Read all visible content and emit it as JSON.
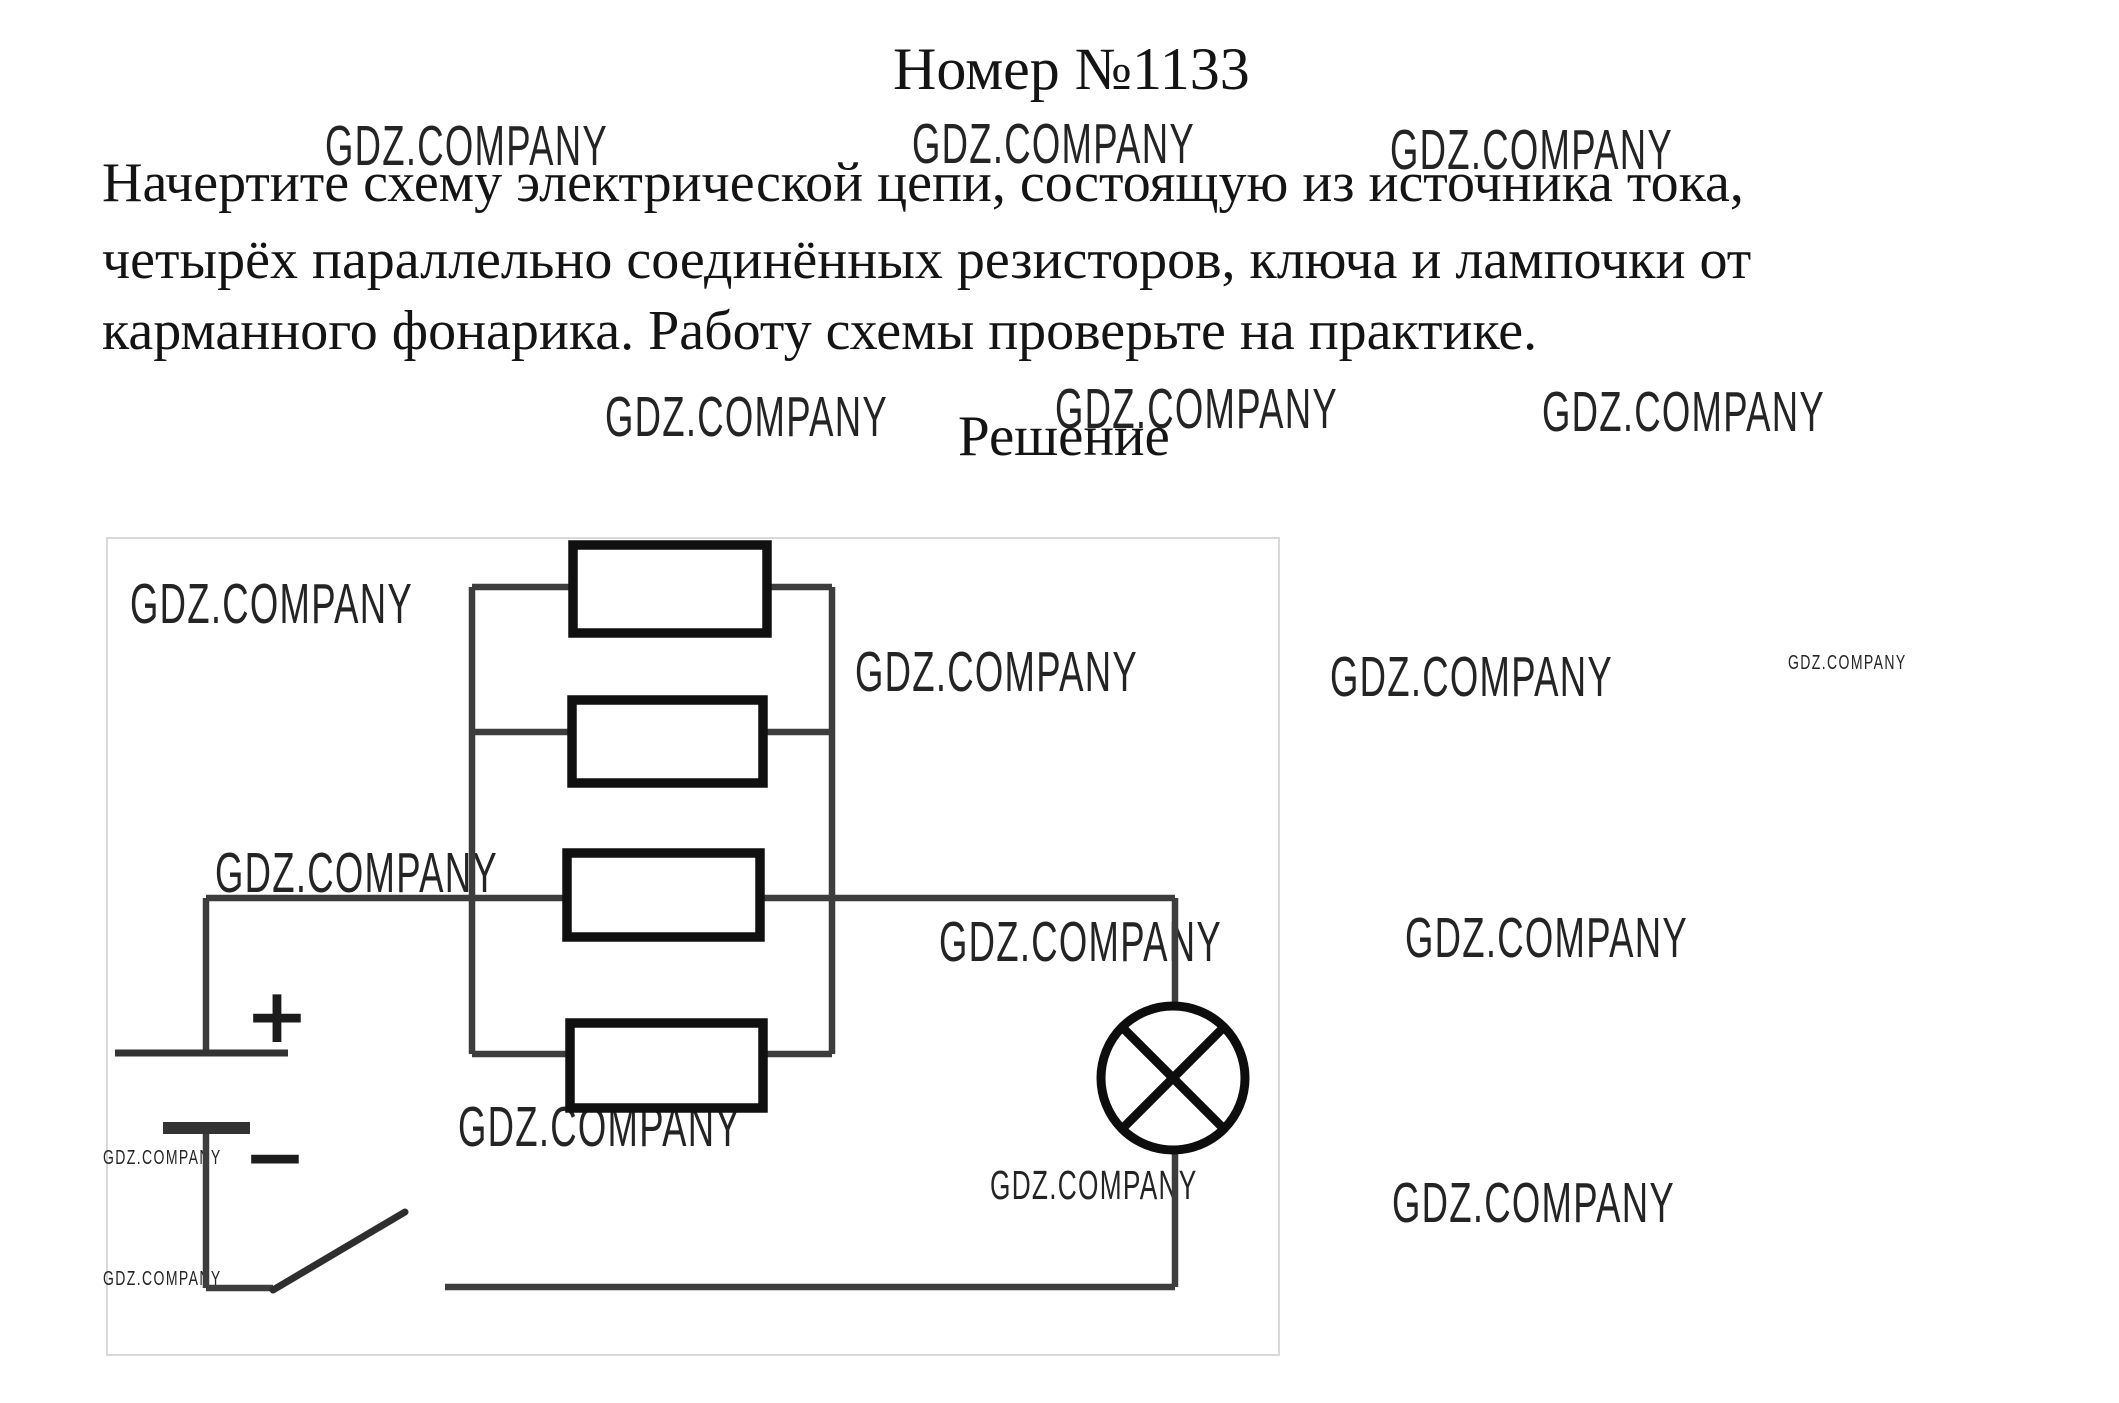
{
  "page": {
    "title": "Номер №1133",
    "problem_lines": [
      "Начертите схему электрической цепи, состоящую из источника тока,",
      "четырёх параллельно соединённых резисторов, ключа и лампочки от",
      "карманного фонарика. Работу схемы проверьте на практике."
    ],
    "solution_heading": "Решение"
  },
  "watermark": {
    "text": "GDZ.COMPANY",
    "instances": [
      {
        "x": 325,
        "y": 118,
        "size": "large"
      },
      {
        "x": 912,
        "y": 116,
        "size": "large"
      },
      {
        "x": 1390,
        "y": 122,
        "size": "large"
      },
      {
        "x": 605,
        "y": 389,
        "size": "large"
      },
      {
        "x": 1055,
        "y": 381,
        "size": "large"
      },
      {
        "x": 1542,
        "y": 384,
        "size": "large"
      },
      {
        "x": 130,
        "y": 576,
        "size": "large"
      },
      {
        "x": 855,
        "y": 644,
        "size": "large"
      },
      {
        "x": 1330,
        "y": 649,
        "size": "large"
      },
      {
        "x": 1788,
        "y": 653,
        "size": "small"
      },
      {
        "x": 215,
        "y": 845,
        "size": "large"
      },
      {
        "x": 939,
        "y": 914,
        "size": "large"
      },
      {
        "x": 1405,
        "y": 910,
        "size": "large"
      },
      {
        "x": 458,
        "y": 1099,
        "size": "large"
      },
      {
        "x": 103,
        "y": 1148,
        "size": "small"
      },
      {
        "x": 990,
        "y": 1165,
        "size": "medium"
      },
      {
        "x": 1392,
        "y": 1175,
        "size": "large"
      },
      {
        "x": 103,
        "y": 1269,
        "size": "small"
      }
    ]
  },
  "diagram": {
    "description": "Electric circuit: battery, open switch, lamp and four resistors connected in parallel",
    "battery": {
      "positive_label": "+",
      "negative_label": "−"
    },
    "resistor_count": 4
  }
}
